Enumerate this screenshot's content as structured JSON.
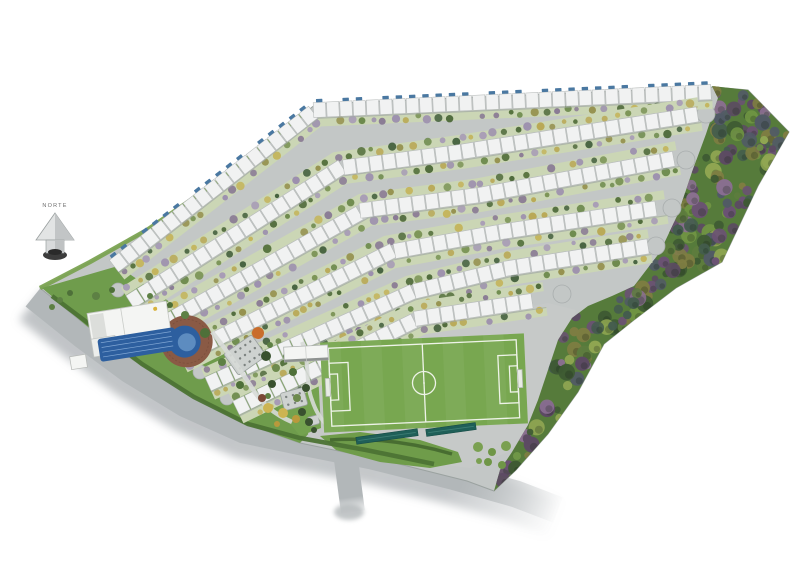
{
  "canvas": {
    "w": 800,
    "h": 565,
    "bg": "#ffffff"
  },
  "compass": {
    "label": "NORTE",
    "x": 55,
    "y": 207
  },
  "palette": {
    "road": "#c3c7c6",
    "roadMain": "#b2b7b9",
    "roadShadow": "#8d9398",
    "siteLine": "#9ba2a0",
    "outerGreen": "#7ba352",
    "roof": "#f1f2f2",
    "roofLine": "#b6bab9",
    "rowShadow": "#a0a6a4",
    "tickBlue": "#4a78a1",
    "bandGreen": "#cbd6b5",
    "lawn": "#6f9c4c",
    "garden": "#74a24f",
    "fieldZone": "#c6c9c8",
    "field": "#78a750",
    "fieldLine": "#eef3e8",
    "forest": "#567b3b",
    "hedge": "#4c7334",
    "deck": "#8a5a45",
    "deckLine": "#6f4636",
    "pool": "#2d5f9f",
    "poolLight": "#5d8cc0",
    "lane": "#8fb3dd",
    "teal": "#1f5f58",
    "tealLine": "#3d7d74",
    "pathLight": "#d7dad7",
    "white": "#f4f5f3",
    "structGray": "#ced2d0",
    "structDot": "#7c8280",
    "buildingEdge": "#8e9290",
    "culdesacStroke": "#a9aeae",
    "goal": "#e8ece5"
  },
  "treeColors": {
    "band": [
      "#55713d",
      "#6d8a4d",
      "#8a7b95",
      "#a79bb6",
      "#95914e",
      "#c4b55e",
      "#46623f",
      "#7b9456",
      "#9c8fae",
      "#506b3c",
      "#b9a957"
    ],
    "forest": [
      "#3e5a33",
      "#515a66",
      "#6a5273",
      "#8b6f92",
      "#7e7d42",
      "#5d7c3e",
      "#6f9443",
      "#445c4e",
      "#90a652",
      "#5c4a63"
    ],
    "cluster": [
      "#7aa051",
      "#86ac5c",
      "#6f9647"
    ],
    "rec": {
      "g": "#5d8044",
      "g2": "#4e7039",
      "o": "#c96d2c",
      "y": "#ccb452",
      "y2": "#b9993c",
      "dk": "#39512f",
      "br": "#7a4836"
    }
  },
  "site": {
    "outline": [
      [
        316,
        104
      ],
      [
        714,
        87
      ],
      [
        748,
        90
      ],
      [
        789,
        132
      ],
      [
        758,
        186
      ],
      [
        722,
        262
      ],
      [
        676,
        288
      ],
      [
        634,
        320
      ],
      [
        604,
        344
      ],
      [
        578,
        392
      ],
      [
        548,
        434
      ],
      [
        516,
        470
      ],
      [
        494,
        491
      ],
      [
        467,
        481
      ],
      [
        387,
        461
      ],
      [
        300,
        443
      ],
      [
        243,
        423
      ],
      [
        187,
        393
      ],
      [
        133,
        360
      ],
      [
        87,
        326
      ],
      [
        40,
        288
      ],
      [
        90,
        262
      ],
      [
        147,
        230
      ],
      [
        220,
        180
      ]
    ],
    "outerGreenEdge": [
      [
        40,
        288
      ],
      [
        90,
        262
      ],
      [
        147,
        230
      ],
      [
        220,
        180
      ],
      [
        310,
        108
      ]
    ]
  },
  "road": {
    "main": [
      [
        34,
        296
      ],
      [
        84,
        336
      ],
      [
        130,
        370
      ],
      [
        186,
        404
      ],
      [
        244,
        430
      ],
      [
        302,
        442
      ],
      [
        372,
        456
      ],
      [
        452,
        476
      ],
      [
        516,
        494
      ],
      [
        558,
        510
      ]
    ],
    "stem": [
      [
        345,
        452
      ],
      [
        353,
        512
      ]
    ],
    "grad": {
      "x1": 34,
      "y1": 296,
      "x2": 560,
      "y2": 512
    },
    "stemGrad": {
      "x1": 345,
      "y1": 458,
      "x2": 353,
      "y2": 514
    }
  },
  "rows": [
    {
      "name": "perimeter-row",
      "pts": [
        [
          114,
          266
        ],
        [
          316,
          110
        ],
        [
          712,
          92
        ]
      ],
      "ticks": true,
      "greens": [
        1
      ]
    },
    {
      "name": "row-1",
      "pts": [
        [
          130,
          302
        ],
        [
          340,
          168
        ],
        [
          460,
          152
        ],
        [
          700,
          114
        ]
      ],
      "ticks": false,
      "greens": [
        1,
        -1
      ]
    },
    {
      "name": "row-2",
      "pts": [
        [
          152,
          330
        ],
        [
          365,
          210
        ],
        [
          480,
          195
        ],
        [
          678,
          158
        ]
      ],
      "ticks": false,
      "greens": [
        1,
        -1
      ]
    },
    {
      "name": "row-3",
      "pts": [
        [
          180,
          357
        ],
        [
          390,
          252
        ],
        [
          500,
          232
        ],
        [
          666,
          207
        ]
      ],
      "ticks": false,
      "greens": [
        1,
        -1
      ]
    },
    {
      "name": "row-4",
      "pts": [
        [
          208,
          384
        ],
        [
          412,
          292
        ],
        [
          510,
          268
        ],
        [
          650,
          246
        ]
      ],
      "ticks": false,
      "greens": [
        1,
        -1
      ]
    },
    {
      "name": "row-5",
      "pts": [
        [
          236,
          408
        ],
        [
          420,
          318
        ],
        [
          545,
          299
        ]
      ],
      "ticks": false,
      "greens": [
        1,
        -1
      ]
    }
  ],
  "rowStyle": {
    "roofW": 15,
    "unitL": 12.2,
    "gap": 1.1,
    "bandOffset": 12.5,
    "bandW": 9,
    "treeStep": 10
  },
  "culdesacs": {
    "right": [
      [
        706,
        114
      ],
      [
        686,
        160
      ],
      [
        672,
        208
      ],
      [
        656,
        246
      ],
      [
        562,
        294
      ]
    ],
    "left": [
      [
        118,
        290
      ],
      [
        144,
        318
      ],
      [
        172,
        345
      ],
      [
        200,
        372
      ],
      [
        227,
        398
      ]
    ]
  },
  "forest": {
    "outline": [
      [
        712,
        86
      ],
      [
        748,
        90
      ],
      [
        789,
        132
      ],
      [
        758,
        186
      ],
      [
        722,
        262
      ],
      [
        676,
        288
      ],
      [
        634,
        320
      ],
      [
        604,
        344
      ],
      [
        578,
        392
      ],
      [
        548,
        434
      ],
      [
        516,
        470
      ],
      [
        494,
        491
      ],
      [
        500,
        470
      ],
      [
        512,
        452
      ],
      [
        528,
        425
      ],
      [
        538,
        400
      ],
      [
        548,
        370
      ],
      [
        558,
        340
      ],
      [
        572,
        318
      ],
      [
        588,
        306
      ],
      [
        612,
        296
      ],
      [
        634,
        286
      ],
      [
        660,
        252
      ],
      [
        678,
        214
      ],
      [
        692,
        172
      ],
      [
        706,
        134
      ],
      [
        718,
        98
      ]
    ],
    "treeCount": 170,
    "seed": 77
  },
  "recArea": {
    "lawn": [
      [
        42,
        288
      ],
      [
        118,
        266
      ],
      [
        150,
        288
      ],
      [
        195,
        320
      ],
      [
        240,
        350
      ],
      [
        285,
        380
      ],
      [
        308,
        400
      ],
      [
        312,
        430
      ],
      [
        300,
        443
      ],
      [
        243,
        423
      ],
      [
        187,
        393
      ],
      [
        133,
        360
      ],
      [
        87,
        326
      ]
    ],
    "hedge": [
      [
        52,
        296
      ],
      [
        96,
        329
      ],
      [
        142,
        364
      ],
      [
        194,
        397
      ],
      [
        248,
        424
      ],
      [
        300,
        438
      ],
      [
        366,
        450
      ],
      [
        434,
        464
      ]
    ],
    "trees": [
      [
        96,
        296,
        4,
        "g"
      ],
      [
        112,
        290,
        3,
        "g2"
      ],
      [
        60,
        300,
        3,
        "g"
      ],
      [
        70,
        293,
        3,
        "g2"
      ],
      [
        52,
        307,
        3,
        "g"
      ],
      [
        150,
        296,
        3,
        "g"
      ],
      [
        170,
        305,
        3,
        "g2"
      ],
      [
        185,
        315,
        4,
        "g"
      ],
      [
        205,
        333,
        5,
        "g2"
      ],
      [
        222,
        362,
        4,
        "g"
      ],
      [
        258,
        333,
        6,
        "o"
      ],
      [
        270,
        345,
        3,
        "g"
      ],
      [
        240,
        385,
        4,
        "g2"
      ],
      [
        262,
        398,
        4,
        "br"
      ],
      [
        268,
        408,
        5,
        "y"
      ],
      [
        283,
        413,
        5,
        "y"
      ],
      [
        296,
        419,
        4,
        "y2"
      ],
      [
        277,
        424,
        3,
        "y2"
      ],
      [
        302,
        412,
        4,
        "dk"
      ],
      [
        309,
        422,
        4,
        "dk"
      ],
      [
        314,
        430,
        3,
        "dk"
      ]
    ],
    "path": "M212,332 C228,352 238,366 252,388 C262,404 274,414 292,422"
  },
  "pool": {
    "rot": -9,
    "cx": 150,
    "cy": 340,
    "deck": {
      "cx": 186,
      "cy": 347,
      "r": 26
    },
    "house": {
      "x": 92,
      "y": 304,
      "w": 80,
      "h": 30
    },
    "housePanel": {
      "x": 94,
      "y": 306,
      "w": 14,
      "h": 26
    },
    "wing": {
      "x": 92,
      "y": 330,
      "w": 24,
      "h": 18
    },
    "water": {
      "x": 98,
      "y": 331,
      "w": 78,
      "h": 23
    },
    "bulge": {
      "cx": 184,
      "cy": 347,
      "r": 16
    },
    "steps": {
      "cx": 186,
      "cy": 348,
      "r": 9
    },
    "hut": {
      "x": 68,
      "y": 344,
      "w": 16,
      "h": 13
    },
    "skylight": {
      "cx": 160,
      "cy": 310,
      "r": 2
    }
  },
  "structures": [
    {
      "name": "playground",
      "x": 228,
      "y": 342,
      "w": 34,
      "h": 26,
      "rot": -35,
      "cols": 5,
      "rowsN": 3
    },
    {
      "name": "kiosk",
      "x": 282,
      "y": 390,
      "w": 24,
      "h": 18,
      "rot": -15,
      "cols": 3,
      "rowsN": 2
    },
    {
      "name": "gatehouse",
      "x": 308,
      "y": 416,
      "w": 11,
      "h": 9,
      "rot": -15,
      "cols": 0,
      "rowsN": 0
    }
  ],
  "fieldZone": {
    "bg": [
      [
        258,
        342
      ],
      [
        420,
        326
      ],
      [
        548,
        303
      ],
      [
        576,
        310
      ],
      [
        562,
        345
      ],
      [
        545,
        395
      ],
      [
        530,
        428
      ],
      [
        508,
        452
      ],
      [
        470,
        468
      ],
      [
        420,
        462
      ],
      [
        350,
        448
      ],
      [
        312,
        440
      ],
      [
        300,
        420
      ],
      [
        284,
        400
      ],
      [
        262,
        370
      ]
    ],
    "garden": [
      [
        258,
        345
      ],
      [
        316,
        337
      ],
      [
        321,
        428
      ],
      [
        300,
        436
      ],
      [
        276,
        406
      ],
      [
        262,
        372
      ]
    ],
    "gardenTrees": [
      [
        266,
        356,
        5
      ],
      [
        276,
        368,
        4
      ],
      [
        286,
        356,
        3
      ],
      [
        272,
        384,
        4
      ],
      [
        293,
        372,
        4
      ],
      [
        300,
        352,
        3
      ],
      [
        306,
        388,
        4
      ],
      [
        268,
        396,
        3
      ],
      [
        297,
        398,
        4
      ]
    ],
    "gardenPath": "M302,342 C310,362 305,382 312,400 C316,412 321,420 330,428",
    "field": {
      "x": 322,
      "y": 338,
      "w": 204,
      "h": 90,
      "rot": -2.6
    },
    "building": {
      "x": 284,
      "y": 346,
      "w": 44,
      "h": 15,
      "rot": -3
    },
    "pergolas": [
      {
        "x": 356,
        "y": 433,
        "w": 62,
        "h": 7,
        "rot": -8
      },
      {
        "x": 426,
        "y": 426,
        "w": 50,
        "h": 7,
        "rot": -8
      }
    ],
    "lawnBlob": [
      [
        320,
        436
      ],
      [
        360,
        432
      ],
      [
        420,
        440
      ],
      [
        458,
        452
      ],
      [
        462,
        462
      ],
      [
        430,
        468
      ],
      [
        380,
        462
      ],
      [
        336,
        450
      ]
    ],
    "blobHedge": "M330,440 Q390,436 452,454",
    "treeCluster": [
      [
        478,
        447,
        5
      ],
      [
        492,
        452,
        4
      ],
      [
        506,
        446,
        5
      ],
      [
        517,
        456,
        4
      ],
      [
        488,
        462,
        4
      ],
      [
        502,
        465,
        4
      ],
      [
        479,
        461,
        3
      ]
    ]
  },
  "seeds": {
    "rows": 13,
    "bands": 29
  }
}
